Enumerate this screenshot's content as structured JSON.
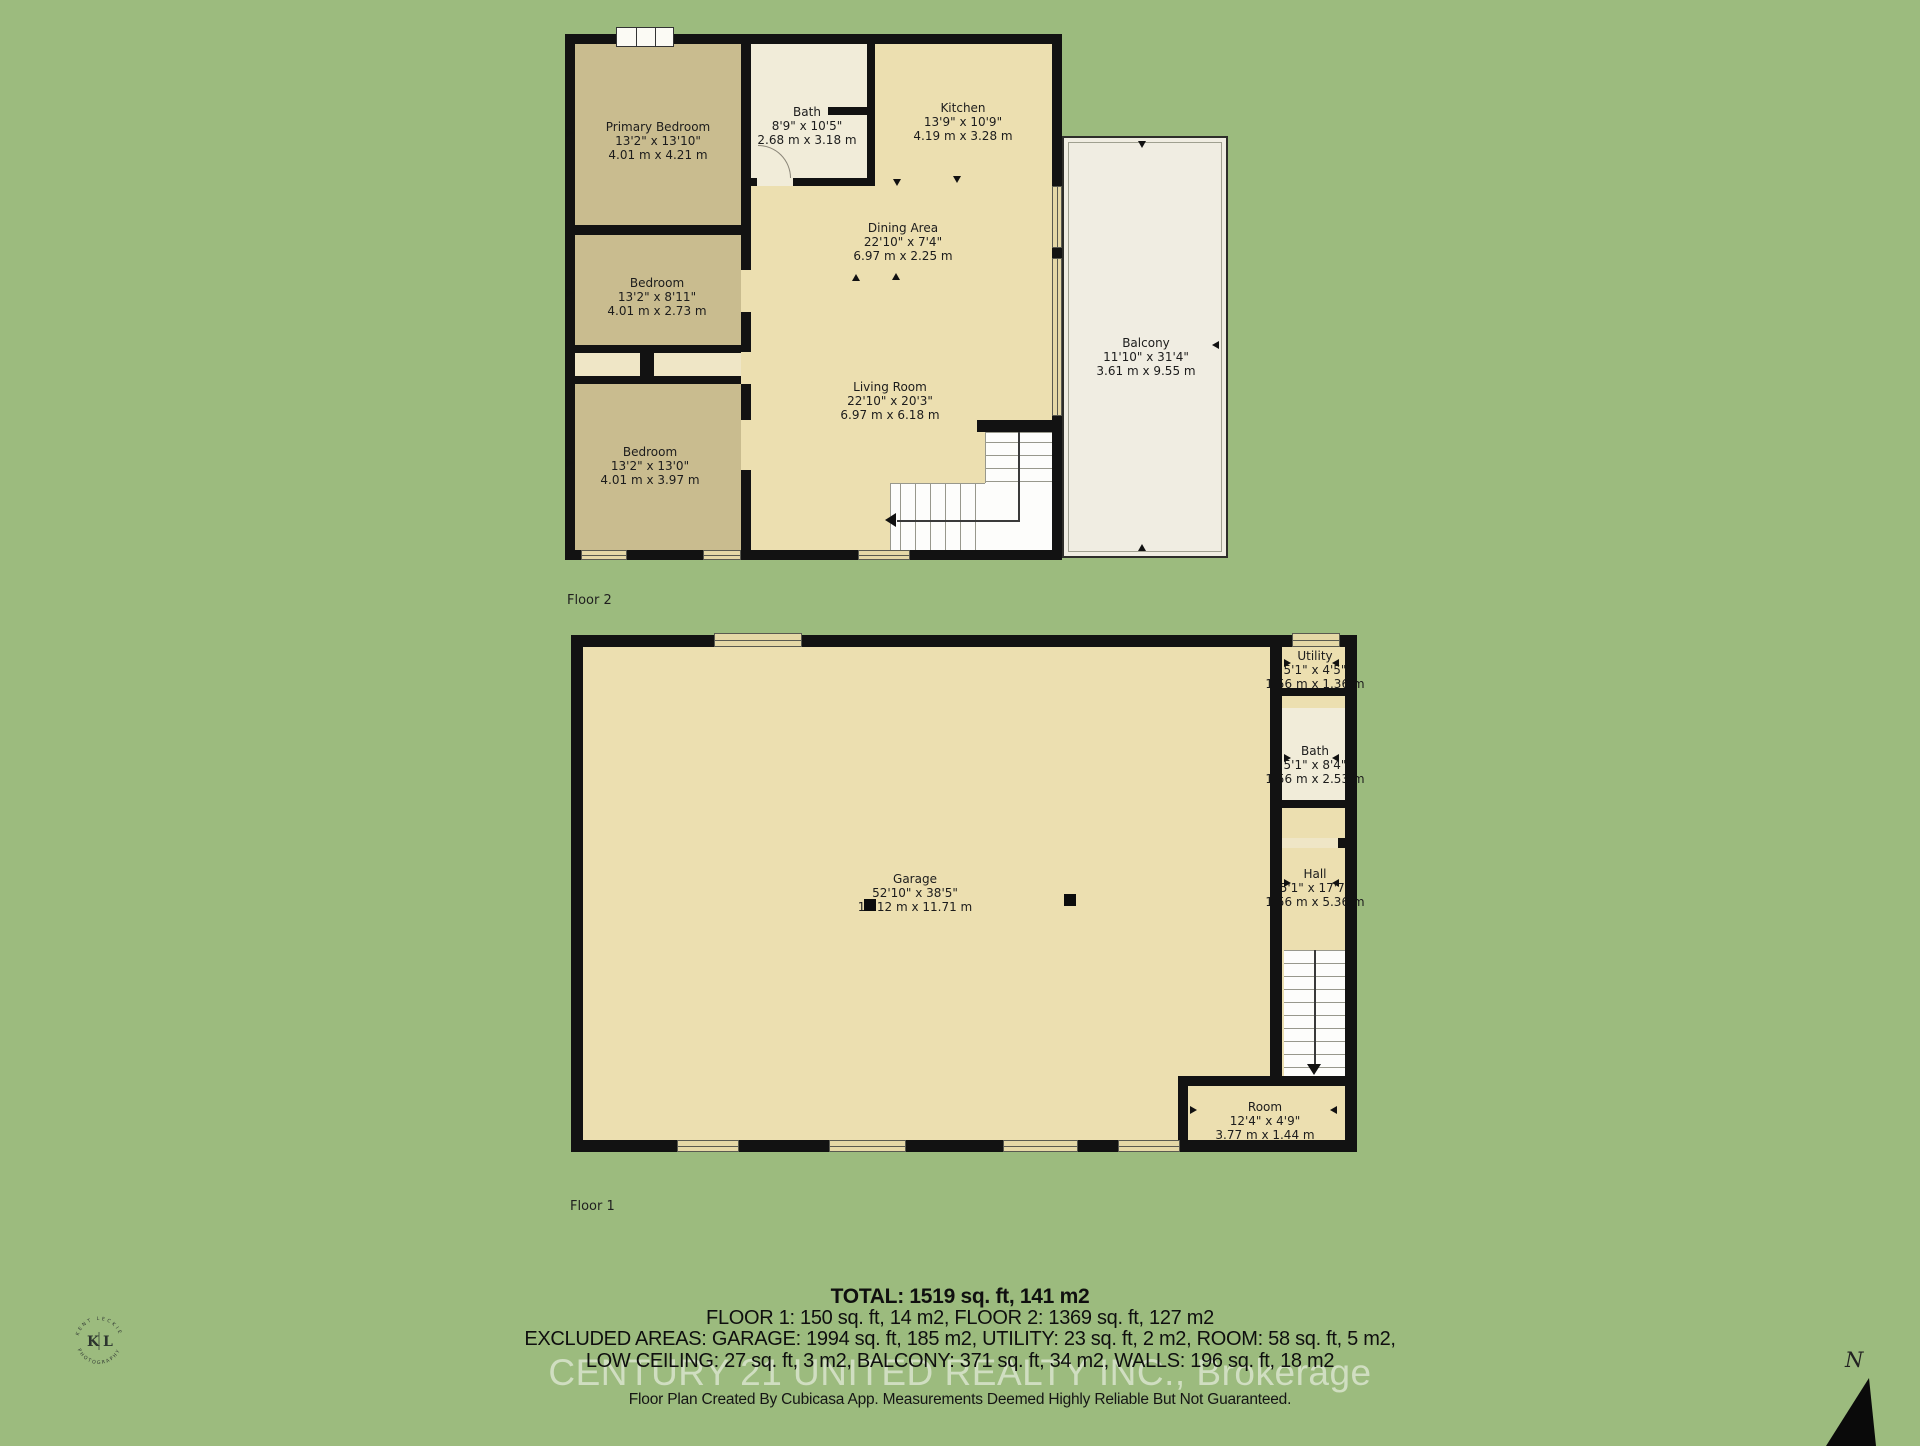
{
  "colors": {
    "background": "#9cbb7e",
    "floor_main": "#ecdfb0",
    "floor_bedroom": "#c9bc8f",
    "floor_bath": "#f1ecd9",
    "balcony": "#f0ede2",
    "wall": "#121212"
  },
  "floors": {
    "floor2": {
      "label": "Floor 2",
      "rooms": [
        {
          "name": "Primary Bedroom",
          "imperial": "13'2\" x 13'10\"",
          "metric": "4.01 m x 4.21 m"
        },
        {
          "name": "Bath",
          "imperial": "8'9\" x 10'5\"",
          "metric": "2.68 m x 3.18 m"
        },
        {
          "name": "Kitchen",
          "imperial": "13'9\" x 10'9\"",
          "metric": "4.19 m x 3.28 m"
        },
        {
          "name": "Dining Area",
          "imperial": "22'10\" x 7'4\"",
          "metric": "6.97 m x 2.25 m"
        },
        {
          "name": "Bedroom",
          "imperial": "13'2\" x 8'11\"",
          "metric": "4.01 m x 2.73 m"
        },
        {
          "name": "Living Room",
          "imperial": "22'10\" x 20'3\"",
          "metric": "6.97 m x 6.18 m"
        },
        {
          "name": "Bedroom",
          "imperial": "13'2\" x 13'0\"",
          "metric": "4.01 m x 3.97 m"
        },
        {
          "name": "Balcony",
          "imperial": "11'10\" x 31'4\"",
          "metric": "3.61 m x 9.55 m"
        }
      ]
    },
    "floor1": {
      "label": "Floor 1",
      "rooms": [
        {
          "name": "Utility",
          "imperial": "5'1\" x 4'5\"",
          "metric": "1.56 m x 1.36 m"
        },
        {
          "name": "Bath",
          "imperial": "5'1\" x 8'4\"",
          "metric": "1.56 m x 2.53 m"
        },
        {
          "name": "Hall",
          "imperial": "5'1\" x 17'7\"",
          "metric": "1.56 m x 5.36 m"
        },
        {
          "name": "Garage",
          "imperial": "52'10\" x 38'5\"",
          "metric": "16.12 m x 11.71 m"
        },
        {
          "name": "Room",
          "imperial": "12'4\" x 4'9\"",
          "metric": "3.77 m x 1.44 m"
        }
      ]
    }
  },
  "summary": {
    "total": "TOTAL: 1519 sq. ft, 141 m2",
    "floors_line": "FLOOR 1: 150 sq. ft, 14 m2, FLOOR 2: 1369 sq. ft, 127 m2",
    "excluded_line1": "EXCLUDED AREAS: GARAGE: 1994 sq. ft, 185 m2, UTILITY: 23 sq. ft, 2 m2, ROOM: 58 sq. ft, 5 m2,",
    "excluded_line2": "LOW CEILING: 27 sq. ft, 3 m2, BALCONY: 371 sq. ft, 34 m2, WALLS: 196 sq. ft, 18 m2",
    "watermark": "CENTURY 21 UNITED REALTY INC., Brokerage",
    "disclaimer": "Floor Plan Created By Cubicasa App. Measurements Deemed Highly Reliable But Not Guaranteed."
  },
  "logo": {
    "top_arc": "KENT LECKIE",
    "bottom_arc": "PHOTOGRAPHY",
    "left_letter": "K",
    "right_letter": "L"
  },
  "compass": {
    "label": "N"
  }
}
